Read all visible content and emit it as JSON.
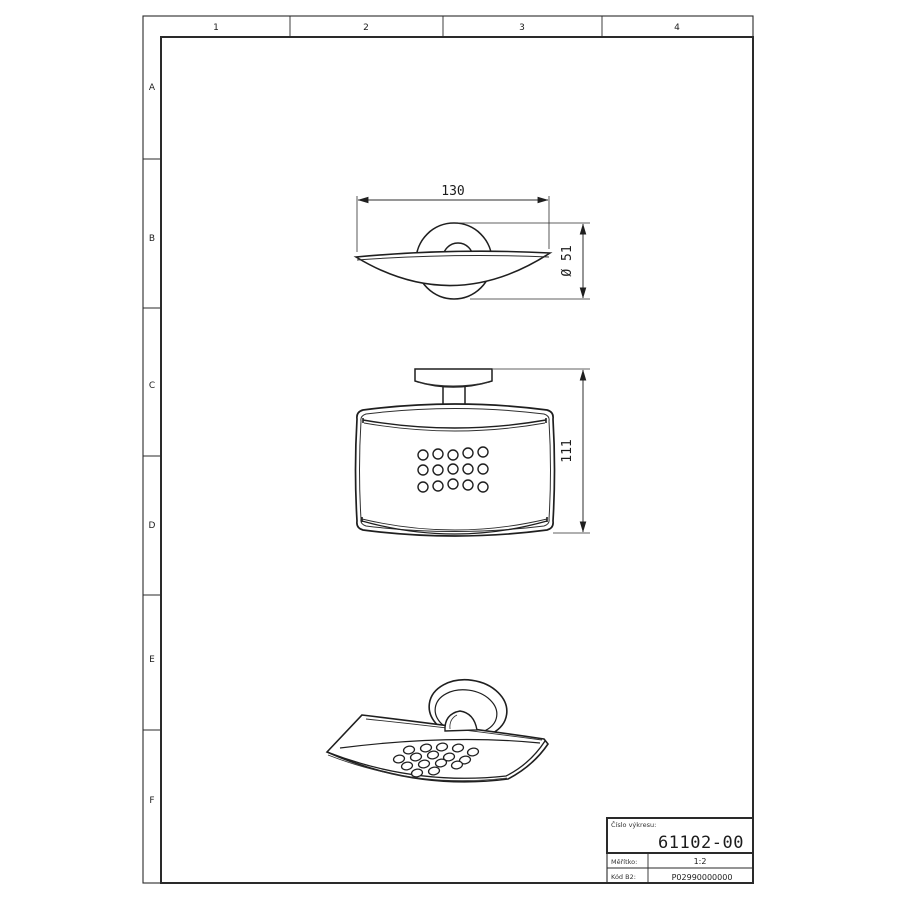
{
  "frame": {
    "column_labels": [
      "1",
      "2",
      "3",
      "4"
    ],
    "row_labels": [
      "A",
      "B",
      "C",
      "D",
      "E",
      "F"
    ]
  },
  "title_block": {
    "drawing_number_label": "Číslo výkresu:",
    "drawing_number": "61102-00",
    "scale_label": "Měřítko:",
    "scale_value": "1:2",
    "code_label": "Kód B2:",
    "code_value": "P02990000000"
  },
  "dimensions": {
    "top_view_width": "130",
    "mount_diameter": "Ø 51",
    "front_view_height": "111"
  },
  "drawing": {
    "front_view_holes": [
      [
        423,
        455
      ],
      [
        438,
        454
      ],
      [
        453,
        455
      ],
      [
        468,
        453
      ],
      [
        483,
        452
      ],
      [
        423,
        470
      ],
      [
        438,
        470
      ],
      [
        453,
        469
      ],
      [
        468,
        469
      ],
      [
        483,
        469
      ],
      [
        423,
        487
      ],
      [
        438,
        486
      ],
      [
        453,
        484
      ],
      [
        468,
        485
      ],
      [
        483,
        487
      ]
    ],
    "iso_view_holes": [
      [
        409,
        750
      ],
      [
        426,
        748
      ],
      [
        442,
        747
      ],
      [
        458,
        748
      ],
      [
        473,
        752
      ],
      [
        399,
        759
      ],
      [
        416,
        757
      ],
      [
        433,
        755
      ],
      [
        449,
        757
      ],
      [
        465,
        760
      ],
      [
        407,
        766
      ],
      [
        424,
        764
      ],
      [
        441,
        763
      ],
      [
        457,
        765
      ],
      [
        417,
        773
      ],
      [
        434,
        771
      ]
    ]
  },
  "colors": {
    "line": "#1f1f1f",
    "background": "#ffffff"
  }
}
